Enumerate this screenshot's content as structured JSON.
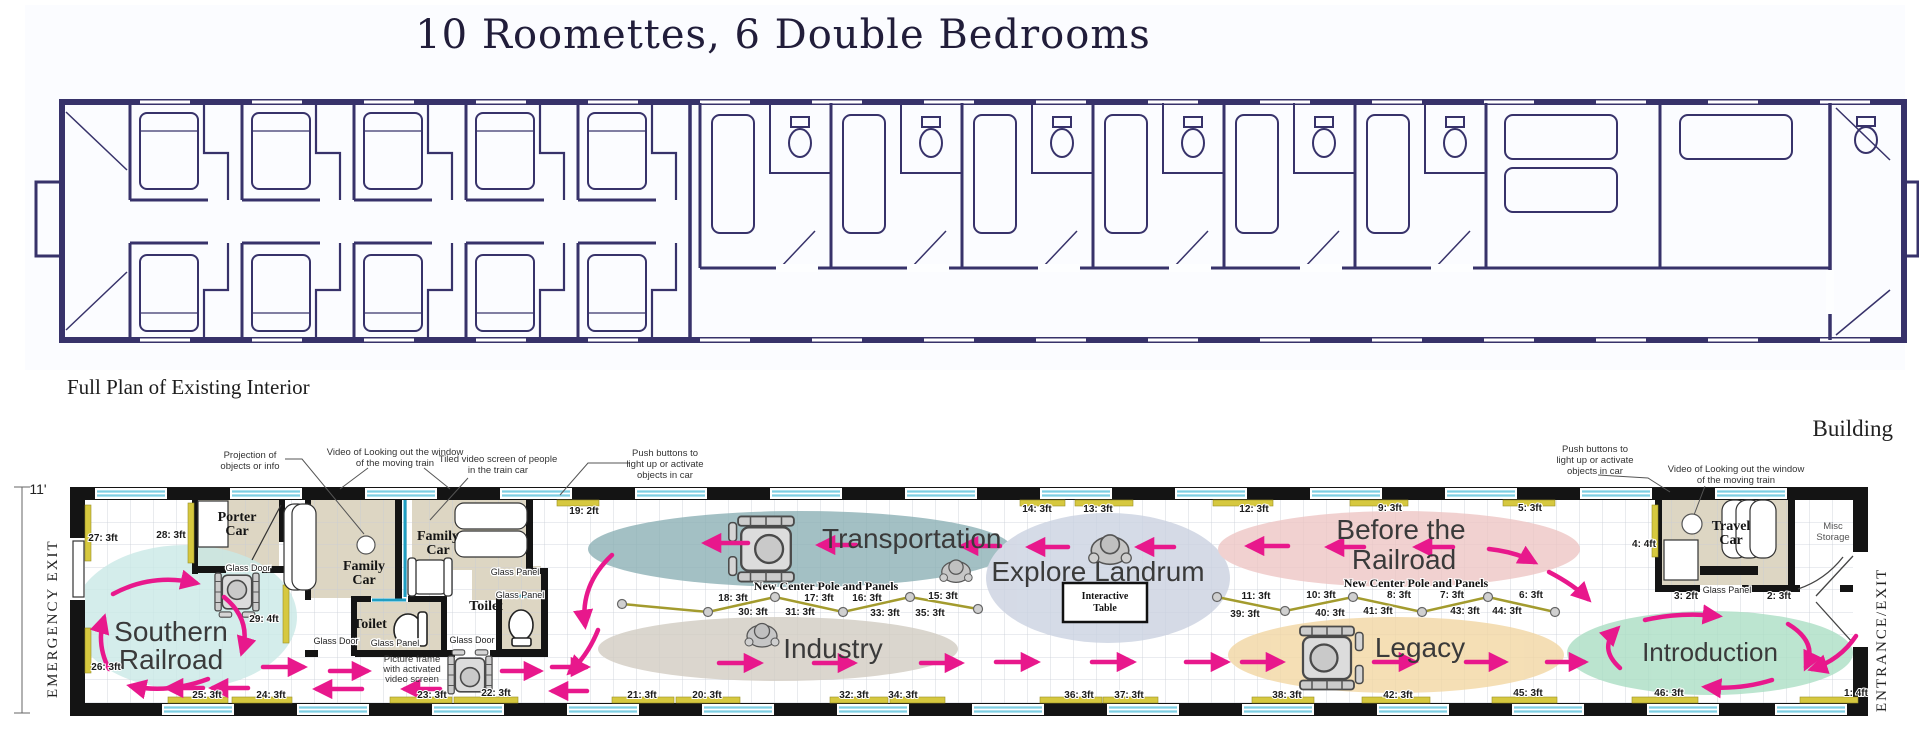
{
  "title": "10 Roomettes, 6 Double Bedrooms",
  "caption": "Full Plan of Existing Interior",
  "building": "Building",
  "dim": {
    "height": "11'"
  },
  "exits": {
    "left": "EMERGENCY EXIT",
    "right": "ENTRANCE/EXIT"
  },
  "zones": {
    "southern_l1": "Southern",
    "southern_l2": "Railroad",
    "transportation": "Transportation",
    "industry": "Industry",
    "explore": "Explore Landrum",
    "before_l1": "Before the",
    "before_l2": "Railroad",
    "legacy": "Legacy",
    "introduction": "Introduction"
  },
  "rooms": {
    "porter_l1": "Porter",
    "porter_l2": "Car",
    "family_l1": "Family",
    "family_l2": "Car",
    "toilet": "Toilet",
    "travel_l1": "Travel",
    "travel_l2": "Car",
    "misc_l1": "Misc",
    "misc_l2": "Storage"
  },
  "labels": {
    "glass_door": "Glass Door",
    "glass_panel": "Glass Panel",
    "pole": "New Center Pole and Panels",
    "table_l1": "Interactive",
    "table_l2": "Table"
  },
  "annotations": {
    "projection_l1": "Projection of",
    "projection_l2": "objects or info",
    "video_l1": "Video of Looking out the window",
    "video_l2": "of the moving train",
    "tiled_l1": "Tiled video screen of people",
    "tiled_l2": "in the train car",
    "push_l1": "Push buttons to",
    "push_l2": "light up or activate",
    "push_l3": "objects in car",
    "picture_l1": "Picture frame",
    "picture_l2": "with activated",
    "picture_l3": "video screen"
  },
  "measurements": {
    "m1": "1: 4ft",
    "m2": "2: 3ft",
    "m3": "3: 2ft",
    "m4": "4: 4ft",
    "m5": "5: 3ft",
    "m6": "6: 3ft",
    "m7": "7: 3ft",
    "m8": "8: 3ft",
    "m9": "9: 3ft",
    "m10": "10: 3ft",
    "m11": "11: 3ft",
    "m12": "12: 3ft",
    "m13": "13: 3ft",
    "m14": "14: 3ft",
    "m15": "15: 3ft",
    "m16": "16: 3ft",
    "m17": "17: 3ft",
    "m18": "18: 3ft",
    "m19": "19: 2ft",
    "m20": "20: 3ft",
    "m21": "21: 3ft",
    "m22": "22: 3ft",
    "m23": "23: 3ft",
    "m24": "24: 3ft",
    "m25": "25: 3ft",
    "m26": "26: 3ft",
    "m27": "27: 3ft",
    "m28": "28: 3ft",
    "m29": "29: 4ft",
    "m30": "30: 3ft",
    "m31": "31: 3ft",
    "m32": "32: 3ft",
    "m33": "33: 3ft",
    "m34": "34: 3ft",
    "m35": "35: 3ft",
    "m36": "36: 3ft",
    "m37": "37: 3ft",
    "m38": "38: 3ft",
    "m39": "39: 3ft",
    "m40": "40: 3ft",
    "m41": "41: 3ft",
    "m42": "42: 3ft",
    "m43": "43: 3ft",
    "m44": "44: 3ft",
    "m45": "45: 3ft",
    "m46": "46: 3ft"
  },
  "colors": {
    "arrow": "#e8188c",
    "southern": "#c9e9e6",
    "transportation": "#8db1b6",
    "industry": "#d2ccc2",
    "explore": "#cbd2e1",
    "before": "#eec6c5",
    "legacy": "#f2d7a3",
    "introduction": "#abdec4",
    "room_fill": "#ddd6c3",
    "panel_strip": "#d6c83f",
    "window_stripe": "#8fd8e8",
    "plan_ink": "#37326a"
  }
}
